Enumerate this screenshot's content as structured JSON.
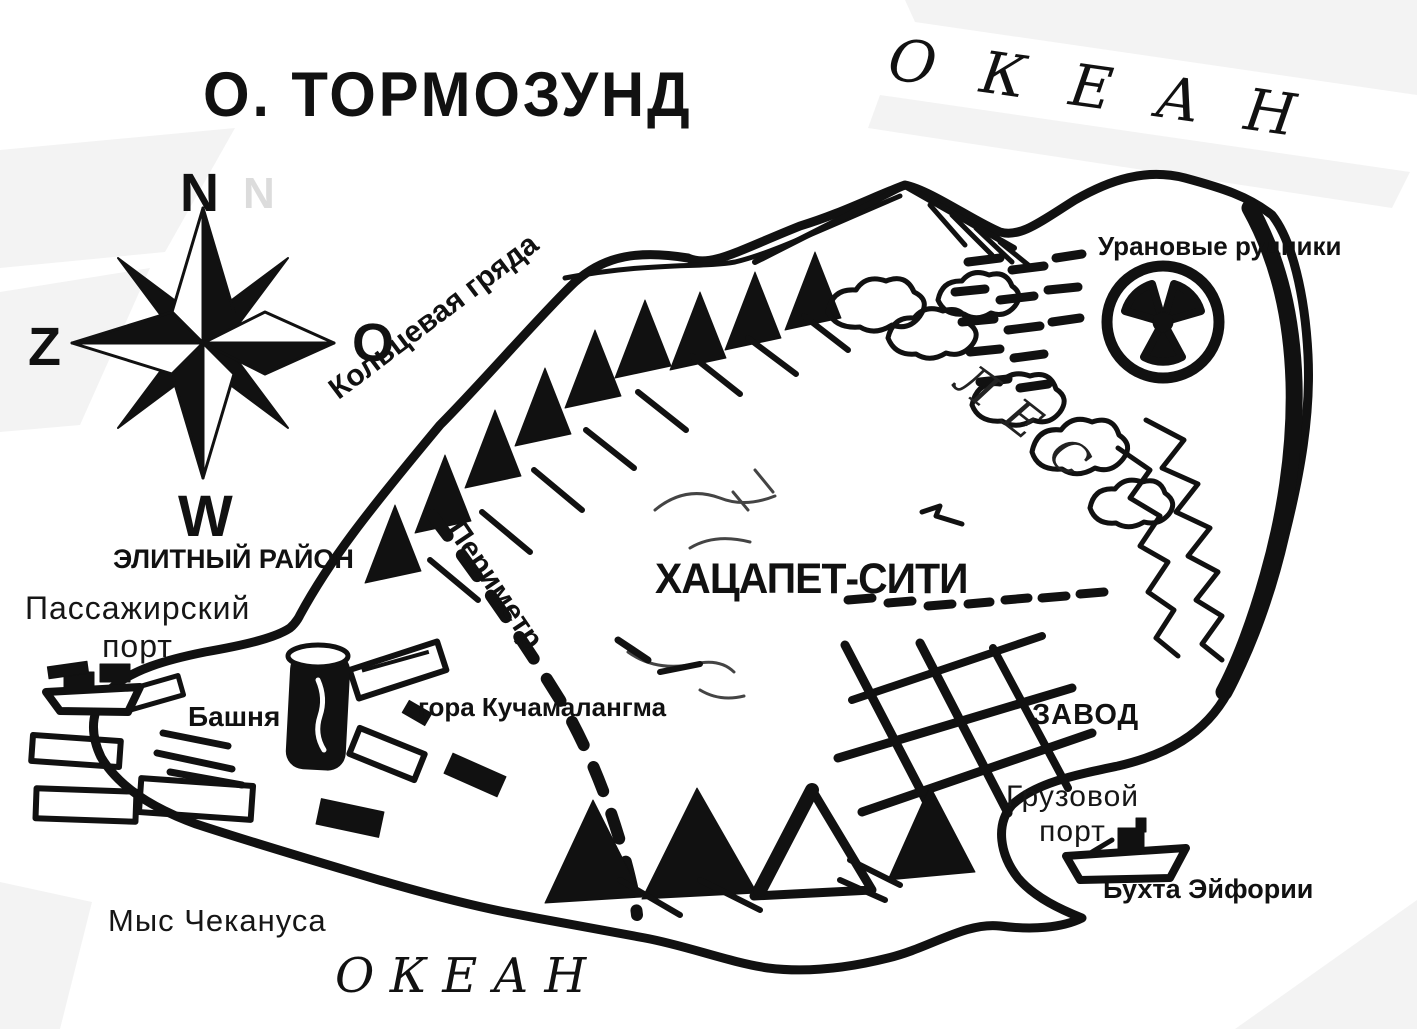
{
  "title": "О. ТОРМОЗУНД",
  "ocean": {
    "top": "ОКЕАН",
    "bottom": "ОКЕАН"
  },
  "compass": {
    "n": "N",
    "z": "Z",
    "o": "O",
    "w": "W",
    "ghost_n": "N"
  },
  "features": {
    "ridge": "Кольцевая гряда",
    "uranium_mines": "Урановые рудники",
    "forest": [
      "Л",
      "Е",
      "С"
    ],
    "city": "ХАЦАПЕТ-СИТИ",
    "perimeter": "Периметр",
    "elite_district": "ЭЛИТНЫЙ РАЙОН",
    "passenger_port": [
      "Пассажирский",
      "порт"
    ],
    "tower": "Башня",
    "mountain": "гора Кучамалангма",
    "factory": "ЗАВОД",
    "cargo_port": [
      "Грузовой",
      "порт"
    ],
    "euphoria_bay": "Бухта Эйфории",
    "cape": "Мыс Чекануса"
  },
  "icons": {
    "compass_rose": "eight-point-compass-rose",
    "radiation": "radiation-trefoil-icon",
    "passenger_ships": "docked-boats",
    "cargo_ship": "cargo-ship"
  },
  "colors": {
    "ink": "#111111",
    "paper": "#ffffff",
    "shade": "#f3f3f3",
    "ghost": "#dcdcdc"
  }
}
